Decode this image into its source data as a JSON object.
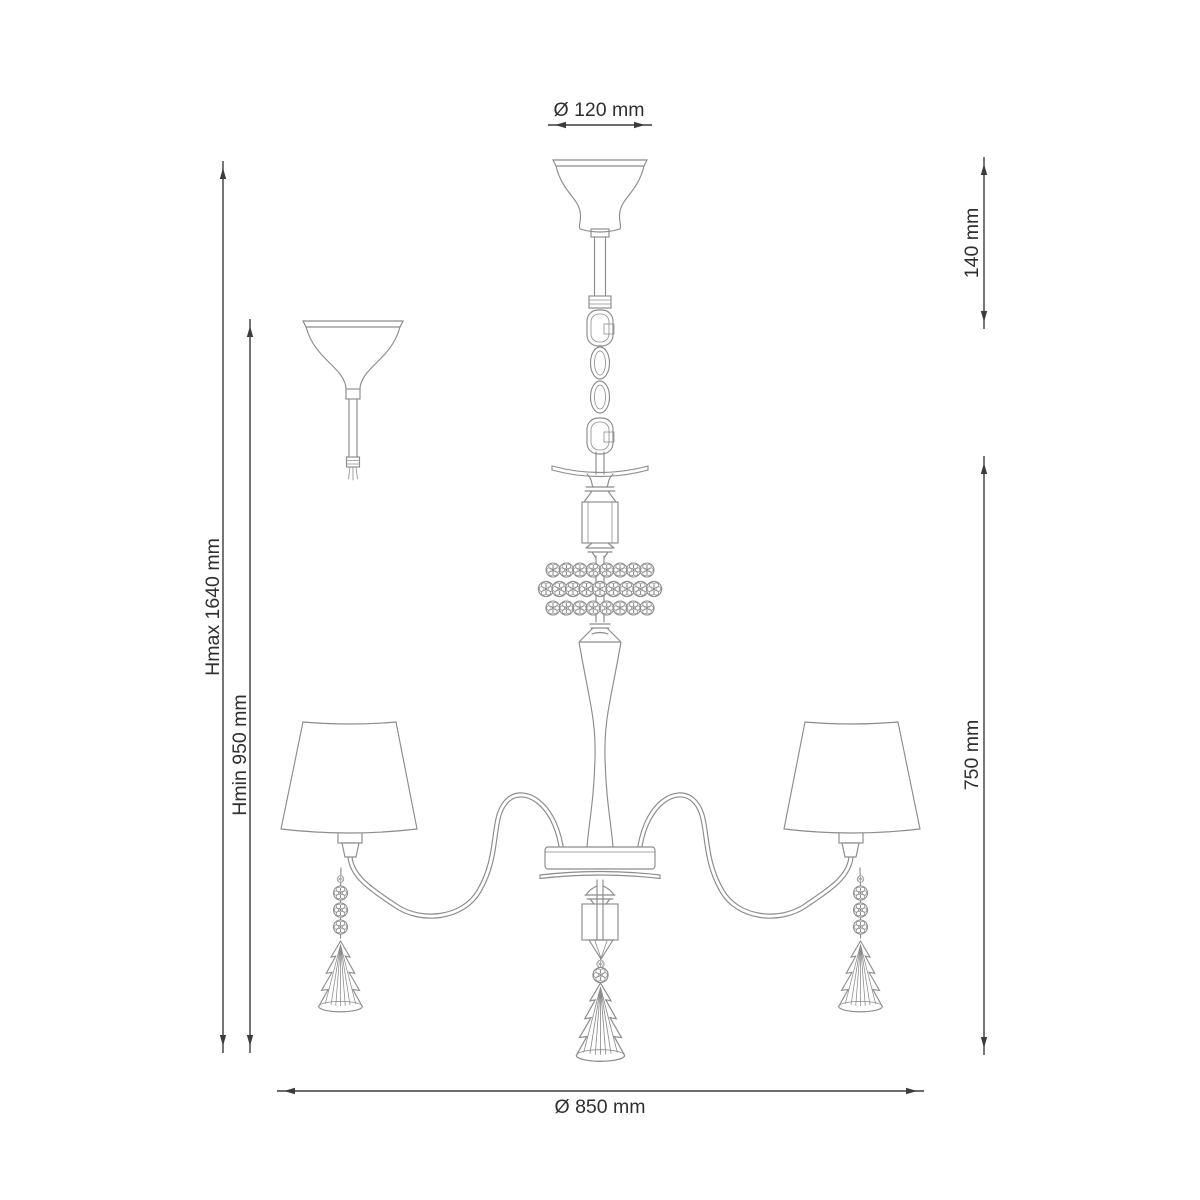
{
  "colors": {
    "line": "#8c8c8c",
    "dimension": "#3c3c3c",
    "text": "#2f2f2f",
    "background": "#ffffff"
  },
  "diagram": {
    "labels": {
      "canopy_diameter": "Ø 120 mm",
      "suspension_height": "140 mm",
      "max_height": "Hmax 1640 mm",
      "min_height": "Hmin 950 mm",
      "body_height": "750 mm",
      "fixture_diameter": "Ø 850 mm"
    }
  }
}
